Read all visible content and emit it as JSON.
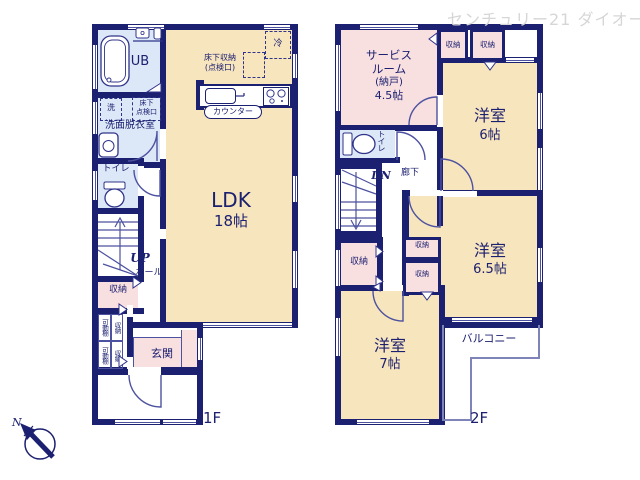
{
  "watermark": "センチュリー21 ダイオー",
  "compass": {
    "north": "N"
  },
  "floor1": {
    "label": "1F",
    "ldk_name": "LDK",
    "ldk_size": "18帖",
    "ub": "UB",
    "washroom": "洗面脱衣室",
    "washer": "洗",
    "underfloor_hatch_line1": "床下",
    "underfloor_hatch_line2": "点検口",
    "underfloor_storage_line1": "床下収納",
    "underfloor_storage_line2": "(点検口)",
    "fridge": "冷",
    "counter": "カウンター",
    "toilet": "トイレ",
    "up": "UP",
    "hall": "ホール",
    "storage": "収納",
    "movable_shelf": "可動棚",
    "entrance": "玄関"
  },
  "floor2": {
    "label": "2F",
    "service_line1": "サービス",
    "service_line2": "ルーム",
    "service_line3": "(納戸)",
    "service_line4": "4.5帖",
    "room6_name": "洋室",
    "room6_size": "6帖",
    "room65_name": "洋室",
    "room65_size": "6.5帖",
    "room7_name": "洋室",
    "room7_size": "7帖",
    "toilet": "トイレ",
    "dn": "DN",
    "corridor": "廊下",
    "storage": "収納",
    "balcony": "バルコニー"
  }
}
